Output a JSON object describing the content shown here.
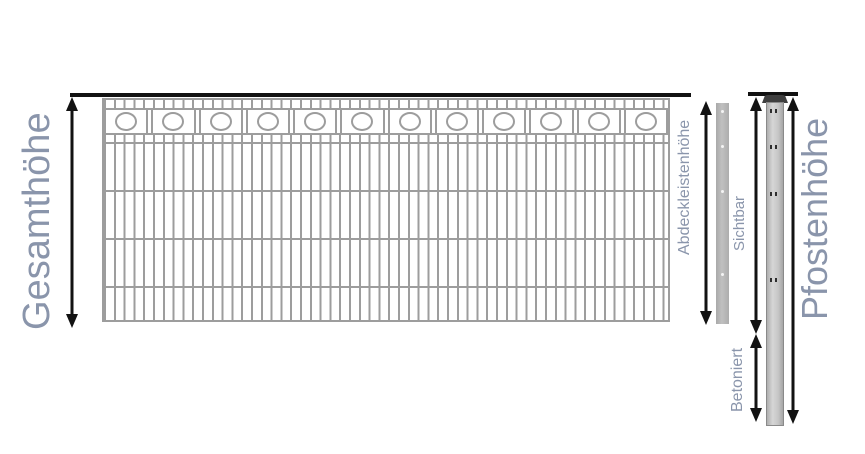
{
  "diagram_title": "Fence height diagram (Doppelstabmatten-Zaun)",
  "labels": {
    "gesamthoehe": "Gesamthöhe",
    "abdeckleistenhoehe": "Abdeckleistenhöhe",
    "sichtbar": "Sichtbar",
    "betoniert": "Betoniert",
    "pfostenhoehe": "Pfostenhöhe"
  },
  "colors": {
    "label": "#8a95ab",
    "line": "#121212",
    "mesh": "#9d9d9d",
    "strip": "#b5b5b5",
    "post": "#c6c6c6",
    "post_cap": "#3f3f3f"
  },
  "fence": {
    "ornament_circle_count": 12
  },
  "cover_strip": {
    "hole_offsets_px": [
      7,
      42,
      87,
      170
    ]
  },
  "post": {
    "hole_offsets_px": [
      6,
      42,
      89,
      175
    ]
  }
}
